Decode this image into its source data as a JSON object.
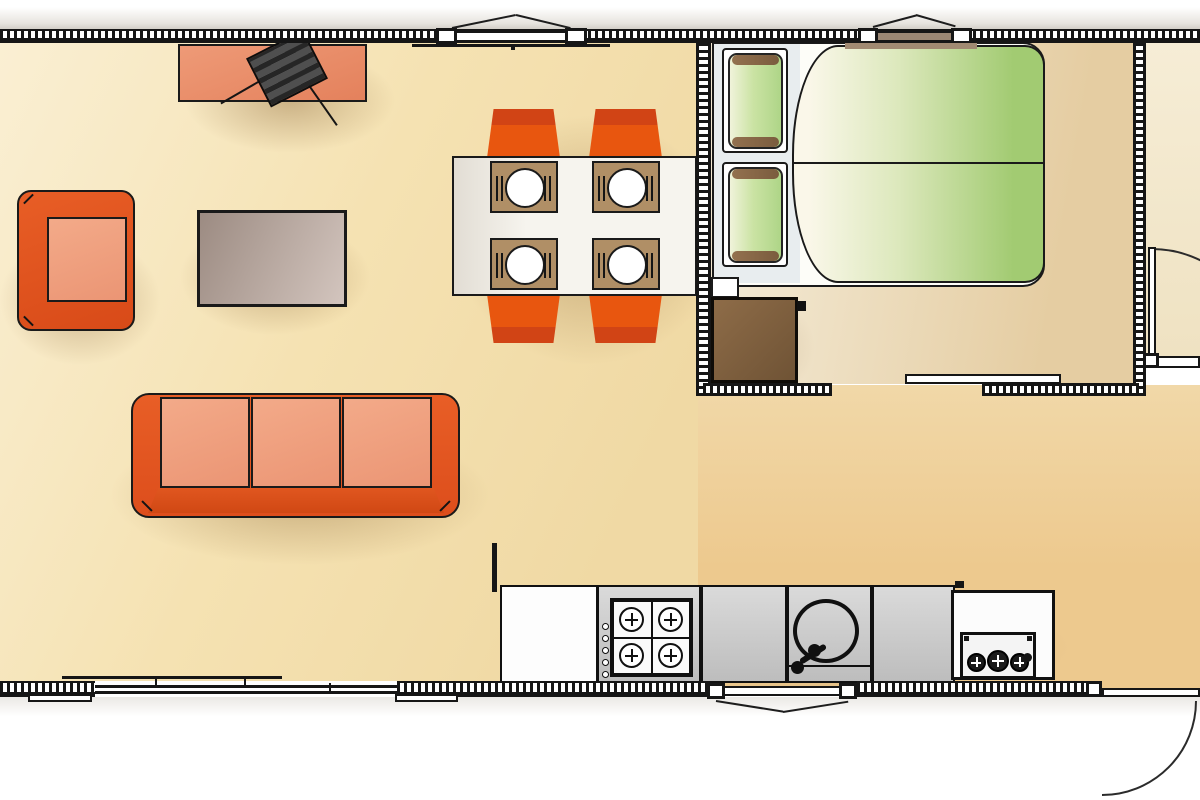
{
  "scene": {
    "kind": "floor-plan",
    "rooms": [
      {
        "id": "living-dining",
        "furniture": [
          {
            "id": "tv-cabinet",
            "color": "salmon"
          },
          {
            "id": "tv",
            "placement": "angled on cabinet",
            "cables": 2
          },
          {
            "id": "armchair",
            "color": "orange"
          },
          {
            "id": "coffee-table",
            "color": "grey-brown"
          },
          {
            "id": "sofa",
            "seats": 3,
            "color": "orange"
          },
          {
            "id": "dining-table",
            "color": "white"
          },
          {
            "id": "dining-chair",
            "count": 4,
            "color": "orange"
          },
          {
            "id": "place-setting",
            "count": 4,
            "parts": [
              "placemat",
              "plate",
              "cutlery"
            ]
          }
        ]
      },
      {
        "id": "kitchen",
        "fixtures": [
          {
            "id": "base-cabinet",
            "color": "white"
          },
          {
            "id": "gas-hob",
            "burners": 4,
            "control_knobs": 5
          },
          {
            "id": "worktop-left"
          },
          {
            "id": "sink",
            "bowl": "round",
            "taps": 1
          },
          {
            "id": "worktop-right"
          },
          {
            "id": "appliance-unit",
            "dials": 3
          }
        ]
      },
      {
        "id": "bedroom",
        "furniture": [
          {
            "id": "double-bed",
            "pillows": 2,
            "duvets": 2,
            "pillow_color": "green",
            "duvet_color": "green"
          },
          {
            "id": "nightstand",
            "color": "brown"
          }
        ]
      },
      {
        "id": "bathroom",
        "note": "partially visible at right edge"
      }
    ],
    "openings": {
      "windows": [
        {
          "id": "window-living",
          "wall": "top",
          "type": "awning"
        },
        {
          "id": "window-bedroom",
          "wall": "top",
          "type": "awning"
        },
        {
          "id": "window-kitchen",
          "wall": "bottom",
          "type": "awning"
        }
      ],
      "doors": [
        {
          "id": "sliding-patio-door",
          "wall": "bottom-left",
          "type": "slider"
        },
        {
          "id": "bedroom-sliding-door",
          "wall": "bedroom-bottom",
          "type": "slider"
        },
        {
          "id": "bathroom-door",
          "type": "hinged",
          "swing": "quarter-arc"
        },
        {
          "id": "entry-door",
          "wall": "bottom-right",
          "type": "hinged",
          "swing": "quarter-arc"
        }
      ]
    }
  },
  "palette": {
    "wall": "#161616",
    "floor_living": "#F5E2B2",
    "floor_living_light": "#FAEFD3",
    "floor_mid": "#EDC98E",
    "floor_bedroom": "#F2E8D2",
    "floor_bedroom_dark": "#E5CDA2",
    "floor_bath": "#F3EAD2",
    "orange_frame": "#E2521D",
    "orange_dark": "#C8441A",
    "chair_orange": "#E8560F",
    "chair_band": "#D14415",
    "cushion_salmon": "#EFA181",
    "tv_stand": "#E98E6B",
    "tv_dark": "#3A3A3A",
    "table_white": "#F6F4EE",
    "mat": "#B08F66",
    "coffee_a": "#9C8B82",
    "coffee_b": "#D3C5BE",
    "pillow_green": "#AED587",
    "pillow_pale": "#F0F3DA",
    "pillow_end": "#8A6A4C",
    "duvet_green": "#A2CB72",
    "duvet_pale": "#FAF7E9",
    "headboard": "#E8EDEF",
    "nightstand": "#7F5F3F",
    "glass_brown": "#9B8774",
    "window_sill_brown": "#A18A72"
  }
}
